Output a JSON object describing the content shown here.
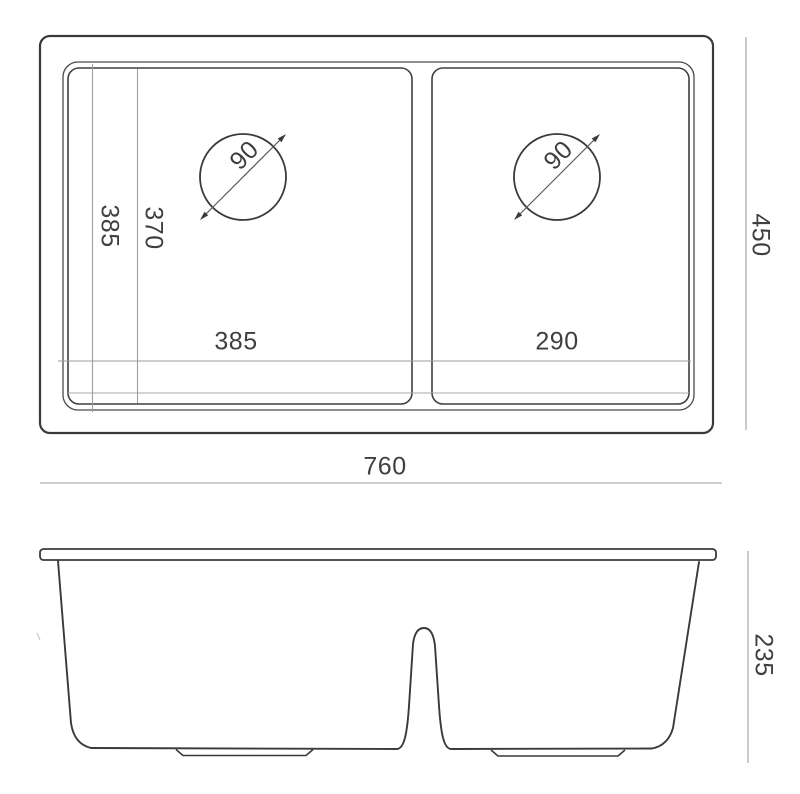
{
  "canvas": {
    "width": "800",
    "height": "794",
    "background": "#ffffff"
  },
  "colors": {
    "outline": "#3a3a3a",
    "rim_line": "#4a4a4a",
    "dimension_line": "#9e9e9e",
    "text": "#3f3f3f"
  },
  "top_view": {
    "labels": {
      "left_drain_diameter": "90",
      "right_drain_diameter": "90",
      "bowl_front_depth": "385",
      "bowl_inner_depth": "370",
      "left_bowl_width": "385",
      "right_bowl_width": "290",
      "overall_depth": "450",
      "overall_width": "760"
    }
  },
  "front_view": {
    "labels": {
      "bowl_height": "235"
    }
  }
}
